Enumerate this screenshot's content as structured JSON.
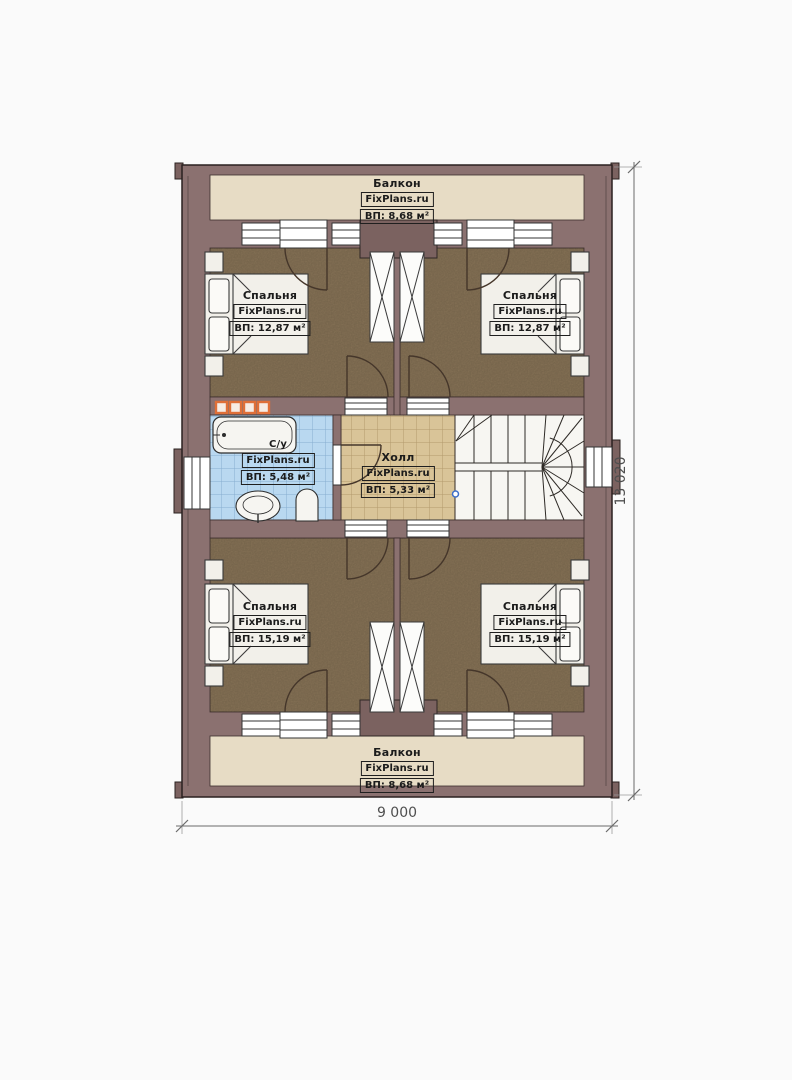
{
  "plan": {
    "rooms": {
      "balcony_top": {
        "name": "Балкон",
        "brand": "FixPlans.ru",
        "area": "ВП: 8,68 м²"
      },
      "bedroom_top_left": {
        "name": "Спальня",
        "brand": "FixPlans.ru",
        "area": "ВП: 12,87 м²"
      },
      "bedroom_top_right": {
        "name": "Спальня",
        "brand": "FixPlans.ru",
        "area": "ВП: 12,87 м²"
      },
      "bathroom": {
        "name": "С/у",
        "brand": "FixPlans.ru",
        "area": "ВП: 5,48 м²"
      },
      "hall": {
        "name": "Холл",
        "brand": "FixPlans.ru",
        "area": "ВП: 5,33 м²"
      },
      "bedroom_bottom_left": {
        "name": "Спальня",
        "brand": "FixPlans.ru",
        "area": "ВП: 15,19 м²"
      },
      "bedroom_bottom_right": {
        "name": "Спальня",
        "brand": "FixPlans.ru",
        "area": "ВП: 15,19 м²"
      },
      "balcony_bottom": {
        "name": "Балкон",
        "brand": "FixPlans.ru",
        "area": "ВП: 8,68 м²"
      }
    },
    "dimensions": {
      "width": "9 000",
      "height": "13 020"
    },
    "colors": {
      "wall": "#8b7170",
      "wall_dark": "#7b6260",
      "floor_bedroom": "#8e795b",
      "floor_balcony": "#e7dcc5",
      "floor_bath": "#b9d8f0",
      "floor_hall": "#d9c498",
      "radiator_accent": "#df6f38",
      "stair_marker_blue": "#3f6fca"
    }
  }
}
